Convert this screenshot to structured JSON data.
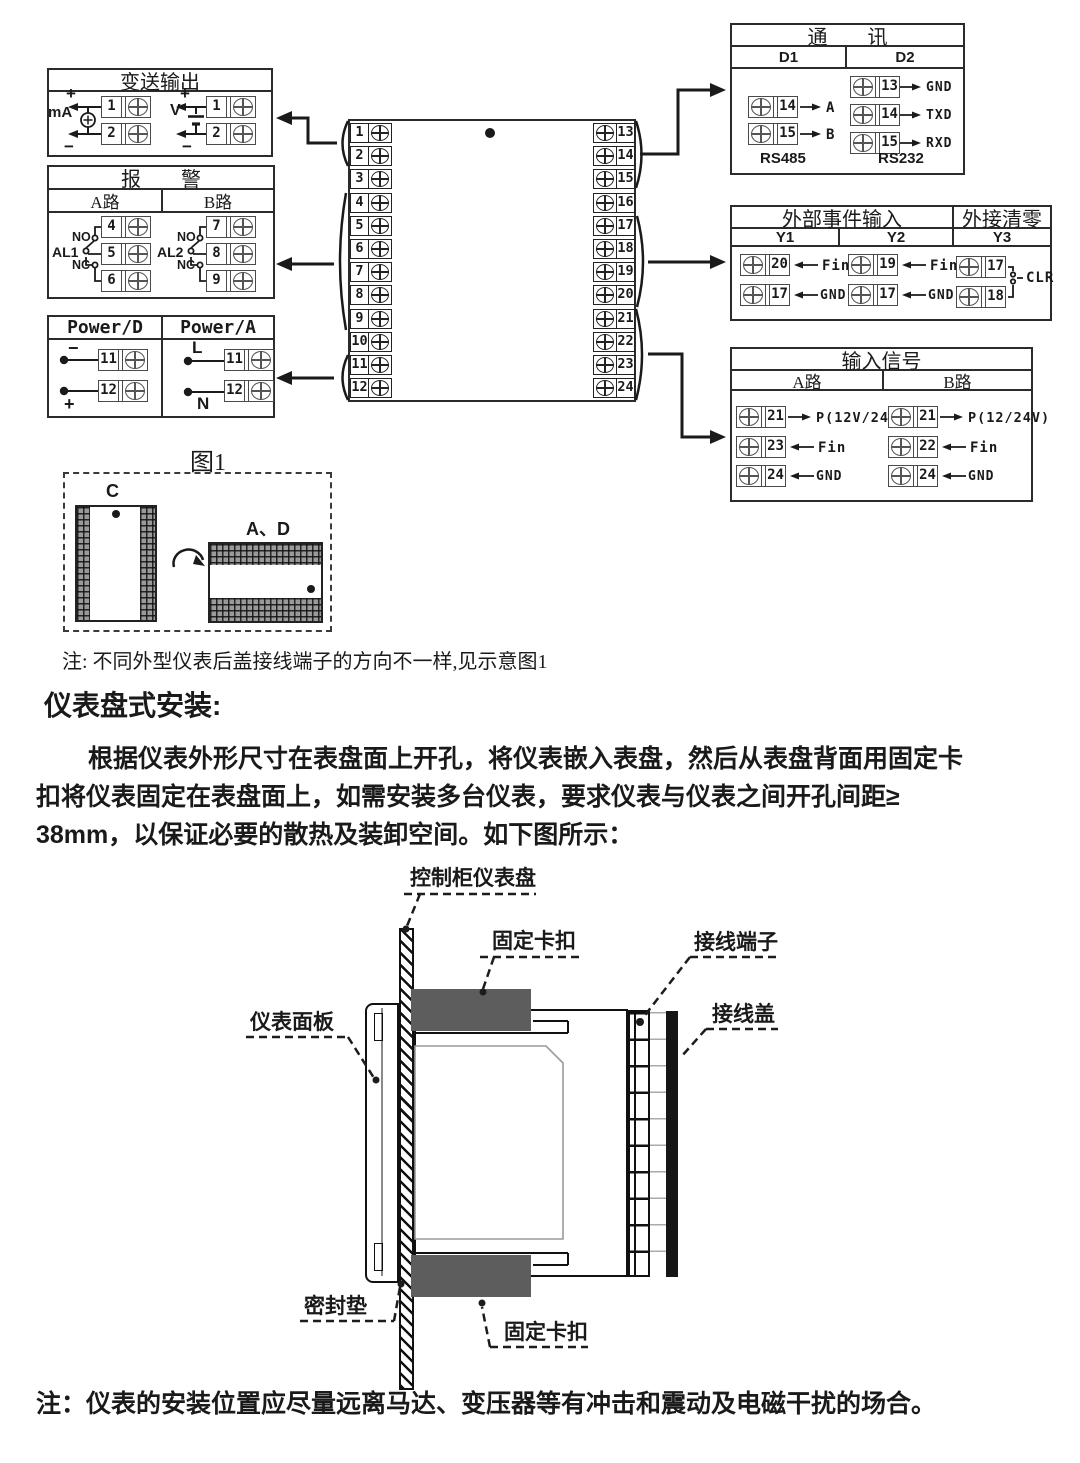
{
  "page": {
    "fig1_label": "图1",
    "note1": "注: 不同外型仪表后盖接线端子的方向不一样,见示意图1",
    "heading": "仪表盘式安装:",
    "para_line1": "根据仪表外形尺寸在表盘面上开孔，将仪表嵌入表盘，然后从表盘背面用固定卡",
    "para_line2": "扣将仪表固定在表盘面上，如需安装多台仪表，要求仪表与仪表之间开孔间距≥",
    "para_line3": "38mm，以保证必要的散热及装卸空间。如下图所示：",
    "note2": "注：仪表的安装位置应尽量远离马达、变压器等有冲击和震动及电磁干扰的场合。"
  },
  "transmission": {
    "title": "变送输出",
    "ma_label": "mA",
    "v_label": "V",
    "plus": "+",
    "minus": "−",
    "ma_terminals": [
      "1",
      "2"
    ],
    "v_terminals": [
      "1",
      "2"
    ]
  },
  "alarm": {
    "title": "报　　警",
    "ch_a": "A路",
    "ch_b": "B路",
    "al1": "AL1",
    "al2": "AL2",
    "no": "NO",
    "nc": "NC",
    "a_terminals": [
      "4",
      "5",
      "6"
    ],
    "b_terminals": [
      "7",
      "8",
      "9"
    ]
  },
  "power": {
    "d_title": "Power/D",
    "a_title": "Power/A",
    "d_minus": "−",
    "d_plus": "+",
    "a_l": "L",
    "a_n": "N",
    "d_terminals": [
      "11",
      "12"
    ],
    "a_terminals": [
      "11",
      "12"
    ]
  },
  "comm": {
    "title": "通　　讯",
    "d1": "D1",
    "d2": "D2",
    "rs485": "RS485",
    "rs232": "RS232",
    "d1_rows": [
      {
        "num": "14",
        "label": "A"
      },
      {
        "num": "15",
        "label": "B"
      }
    ],
    "d2_rows": [
      {
        "num": "13",
        "label": "GND"
      },
      {
        "num": "14",
        "label": "TXD"
      },
      {
        "num": "15",
        "label": "RXD"
      }
    ]
  },
  "event": {
    "title": "外部事件输入",
    "clear_title": "外接清零",
    "y1": "Y1",
    "y2": "Y2",
    "y3": "Y3",
    "y1_rows": [
      {
        "num": "20",
        "label": "Fin"
      },
      {
        "num": "17",
        "label": "GND"
      }
    ],
    "y2_rows": [
      {
        "num": "19",
        "label": "Fin"
      },
      {
        "num": "17",
        "label": "GND"
      }
    ],
    "y3_terminals": [
      "17",
      "18"
    ],
    "clr": "CLR"
  },
  "input": {
    "title": "输入信号",
    "ch_a": "A路",
    "ch_b": "B路",
    "a_rows": [
      {
        "num": "21",
        "label": "P(12V/24V)"
      },
      {
        "num": "23",
        "label": "Fin"
      },
      {
        "num": "24",
        "label": "GND"
      }
    ],
    "b_rows": [
      {
        "num": "21",
        "label": "P(12/24V)"
      },
      {
        "num": "22",
        "label": "Fin"
      },
      {
        "num": "24",
        "label": "GND"
      }
    ]
  },
  "terminal_block": {
    "left": [
      "1",
      "2",
      "3",
      "4",
      "5",
      "6",
      "7",
      "8",
      "9",
      "10",
      "11",
      "12"
    ],
    "right": [
      "13",
      "14",
      "15",
      "16",
      "17",
      "18",
      "19",
      "20",
      "21",
      "22",
      "23",
      "24"
    ]
  },
  "figure1": {
    "label_c": "C",
    "label_ad": "A、D"
  },
  "install": {
    "panel": "控制柜仪表盘",
    "clip_top": "固定卡扣",
    "terminal": "接线端子",
    "cover": "接线盖",
    "front": "仪表面板",
    "gasket": "密封垫",
    "clip_bottom": "固定卡扣"
  }
}
